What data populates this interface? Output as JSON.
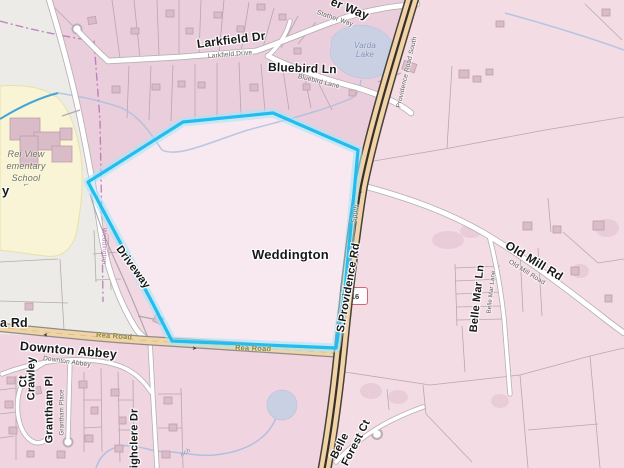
{
  "map": {
    "shield": {
      "text": "16"
    },
    "labels": [
      {
        "id": "way-fragment",
        "text": "er Way",
        "x": 331,
        "y": -5,
        "rot": 22,
        "size": 12,
        "cls": "b"
      },
      {
        "id": "stather-way-small",
        "text": "Stather Way",
        "x": 317,
        "y": 9,
        "rot": 19,
        "size": 6.5,
        "cls": "s"
      },
      {
        "id": "larkfield-dr",
        "text": "Larkfield Dr",
        "x": 197,
        "y": 38,
        "rot": -7,
        "size": 12,
        "cls": "b"
      },
      {
        "id": "larkfield-drive-small",
        "text": "Larkfield Drive",
        "x": 208,
        "y": 53,
        "rot": -5,
        "size": 6.5,
        "cls": "s"
      },
      {
        "id": "bluebird-ln",
        "text": "Bluebird Ln",
        "x": 268,
        "y": 61,
        "rot": 2,
        "size": 12,
        "cls": "b"
      },
      {
        "id": "bluebird-lane-small",
        "text": "Bluebird Lane",
        "x": 298,
        "y": 73,
        "rot": 14,
        "size": 6.5,
        "cls": "s"
      },
      {
        "id": "varda-lake",
        "text": "Varda\nLake",
        "x": 344,
        "y": 41,
        "rot": 0,
        "size": 8,
        "cls": "water",
        "w": 42
      },
      {
        "id": "providence-road-south-small",
        "text": "Providence Road South",
        "x": 399,
        "y": 104,
        "rot": -77,
        "size": 6.5,
        "cls": "s"
      },
      {
        "id": "s-providence-rd",
        "text": "S.Providence Rd",
        "x": 341,
        "y": 326,
        "rot": -80,
        "size": 11,
        "cls": "b"
      },
      {
        "id": "south-small",
        "text": "South",
        "x": 354,
        "y": 219,
        "rot": -80,
        "size": 6.5,
        "cls": "s"
      },
      {
        "id": "old-mill-rd",
        "text": "Old Mill Rd",
        "x": 506,
        "y": 238,
        "rot": 31,
        "size": 12,
        "cls": "b"
      },
      {
        "id": "old-mill-road-small",
        "text": "Old Mill Road",
        "x": 509,
        "y": 258,
        "rot": 32,
        "size": 6.5,
        "cls": "s"
      },
      {
        "id": "belle-mar-ln",
        "text": "Belle Mar Ln",
        "x": 474,
        "y": 326,
        "rot": -84,
        "size": 11,
        "cls": "b"
      },
      {
        "id": "belle-mar-lane-small",
        "text": "Belle Mar Lane",
        "x": 490,
        "y": 310,
        "rot": -84,
        "size": 6,
        "cls": "s"
      },
      {
        "id": "belle-forest-1",
        "text": "Belle",
        "x": 334,
        "y": 452,
        "rot": -63,
        "size": 11,
        "cls": "b"
      },
      {
        "id": "belle-forest-2",
        "text": "Forest Ct",
        "x": 345,
        "y": 459,
        "rot": -63,
        "size": 11,
        "cls": "b"
      },
      {
        "id": "weddington-place",
        "text": "Weddington",
        "x": 252,
        "y": 248,
        "rot": 0,
        "size": 13,
        "cls": "b"
      },
      {
        "id": "driveway",
        "text": "Driveway",
        "x": 118,
        "y": 241,
        "rot": 54,
        "size": 11,
        "cls": "b"
      },
      {
        "id": "weddington-boundary",
        "text": "Weddington",
        "x": 104,
        "y": 224,
        "rot": 90,
        "size": 6.5,
        "cls": "purple"
      },
      {
        "id": "downton-abbey",
        "text": "Downton Abbey",
        "x": 20,
        "y": 339,
        "rot": 5,
        "size": 12.5,
        "cls": "b"
      },
      {
        "id": "downton-abbey-small",
        "text": "Downton Abbey",
        "x": 43,
        "y": 355,
        "rot": 8,
        "size": 6.5,
        "cls": "s"
      },
      {
        "id": "rea-road-1",
        "text": "Rea Road",
        "x": 96,
        "y": 331,
        "rot": 4,
        "size": 7.5,
        "cls": "road"
      },
      {
        "id": "rea-road-2",
        "text": "Rea Road",
        "x": 235,
        "y": 344,
        "rot": 2,
        "size": 7.5,
        "cls": "road"
      },
      {
        "id": "rea-rd-fragment",
        "text": "a Rd",
        "x": 0,
        "y": 316,
        "rot": 0,
        "size": 12.5,
        "cls": "b"
      },
      {
        "id": "y-fragment",
        "text": "y",
        "x": 2,
        "y": 184,
        "rot": 0,
        "size": 13,
        "cls": "b"
      },
      {
        "id": "school-name",
        "text": "Rei View\nementary\nSchool",
        "x": -16,
        "y": 148,
        "rot": 0,
        "size": 9,
        "cls": "school",
        "w": 84
      },
      {
        "id": "school-arrow-icon",
        "text": "←",
        "x": 22,
        "y": 180,
        "rot": -15,
        "size": 8,
        "cls": "s"
      },
      {
        "id": "branch-fragment",
        "text": "nch",
        "x": 181,
        "y": 452,
        "rot": -30,
        "size": 6.5,
        "cls": "water"
      },
      {
        "id": "crawley-ct-1",
        "text": "Crawley",
        "x": 32,
        "y": 394,
        "rot": -90,
        "size": 11,
        "cls": "b"
      },
      {
        "id": "crawley-ct-2",
        "text": "Ct",
        "x": 24,
        "y": 381,
        "rot": -90,
        "size": 11,
        "cls": "b"
      },
      {
        "id": "grantham-pl",
        "text": "Grantham Pl",
        "x": 50,
        "y": 437,
        "rot": -90,
        "size": 11,
        "cls": "b"
      },
      {
        "id": "grantham-place-small",
        "text": "Grantham Place",
        "x": 63,
        "y": 432,
        "rot": -90,
        "size": 6,
        "cls": "s"
      },
      {
        "id": "highclere-dr",
        "text": "Highclere Dr",
        "x": 135,
        "y": 470,
        "rot": -90,
        "size": 11,
        "cls": "b"
      },
      {
        "id": "rea-arrow-1",
        "text": "➤",
        "x": 48,
        "y": 330,
        "rot": 178,
        "size": 6,
        "cls": "arrow"
      },
      {
        "id": "rea-arrow-2",
        "text": "➤",
        "x": 192,
        "y": 346,
        "rot": 2,
        "size": 6,
        "cls": "arrow"
      },
      {
        "id": "highway-arrow",
        "text": "➤",
        "x": 362,
        "y": 190,
        "rot": -104,
        "size": 6,
        "cls": "arrow"
      }
    ],
    "colors": {
      "selection": "#22bdee",
      "selection-glow": "#a5e6f8",
      "highway-fill": "#f1d3a5",
      "highway-casing": "#45403a",
      "highway-center": "#35302c",
      "rea-fill": "#f1d4a6",
      "rea-casing": "#8f8a8c",
      "road-fill": "#ffffff",
      "road-casing": "#b7afb4",
      "water": "#c9d0e4",
      "stream": "#a9bedf",
      "stream-bright": "#43a4d8",
      "admin": "#b06fb0",
      "land": "#f2d8e2",
      "land-dark": "#ebcedb",
      "land-east": "#f4dce5",
      "land-south": "#f0d4df",
      "cream": "#edebe7",
      "school": "#f8f4d5",
      "parcel-line": "#ab9fa8",
      "building": "#d9bcc8",
      "building-stroke": "#bf9fad",
      "selection-fill": "#f9ebf2"
    }
  }
}
